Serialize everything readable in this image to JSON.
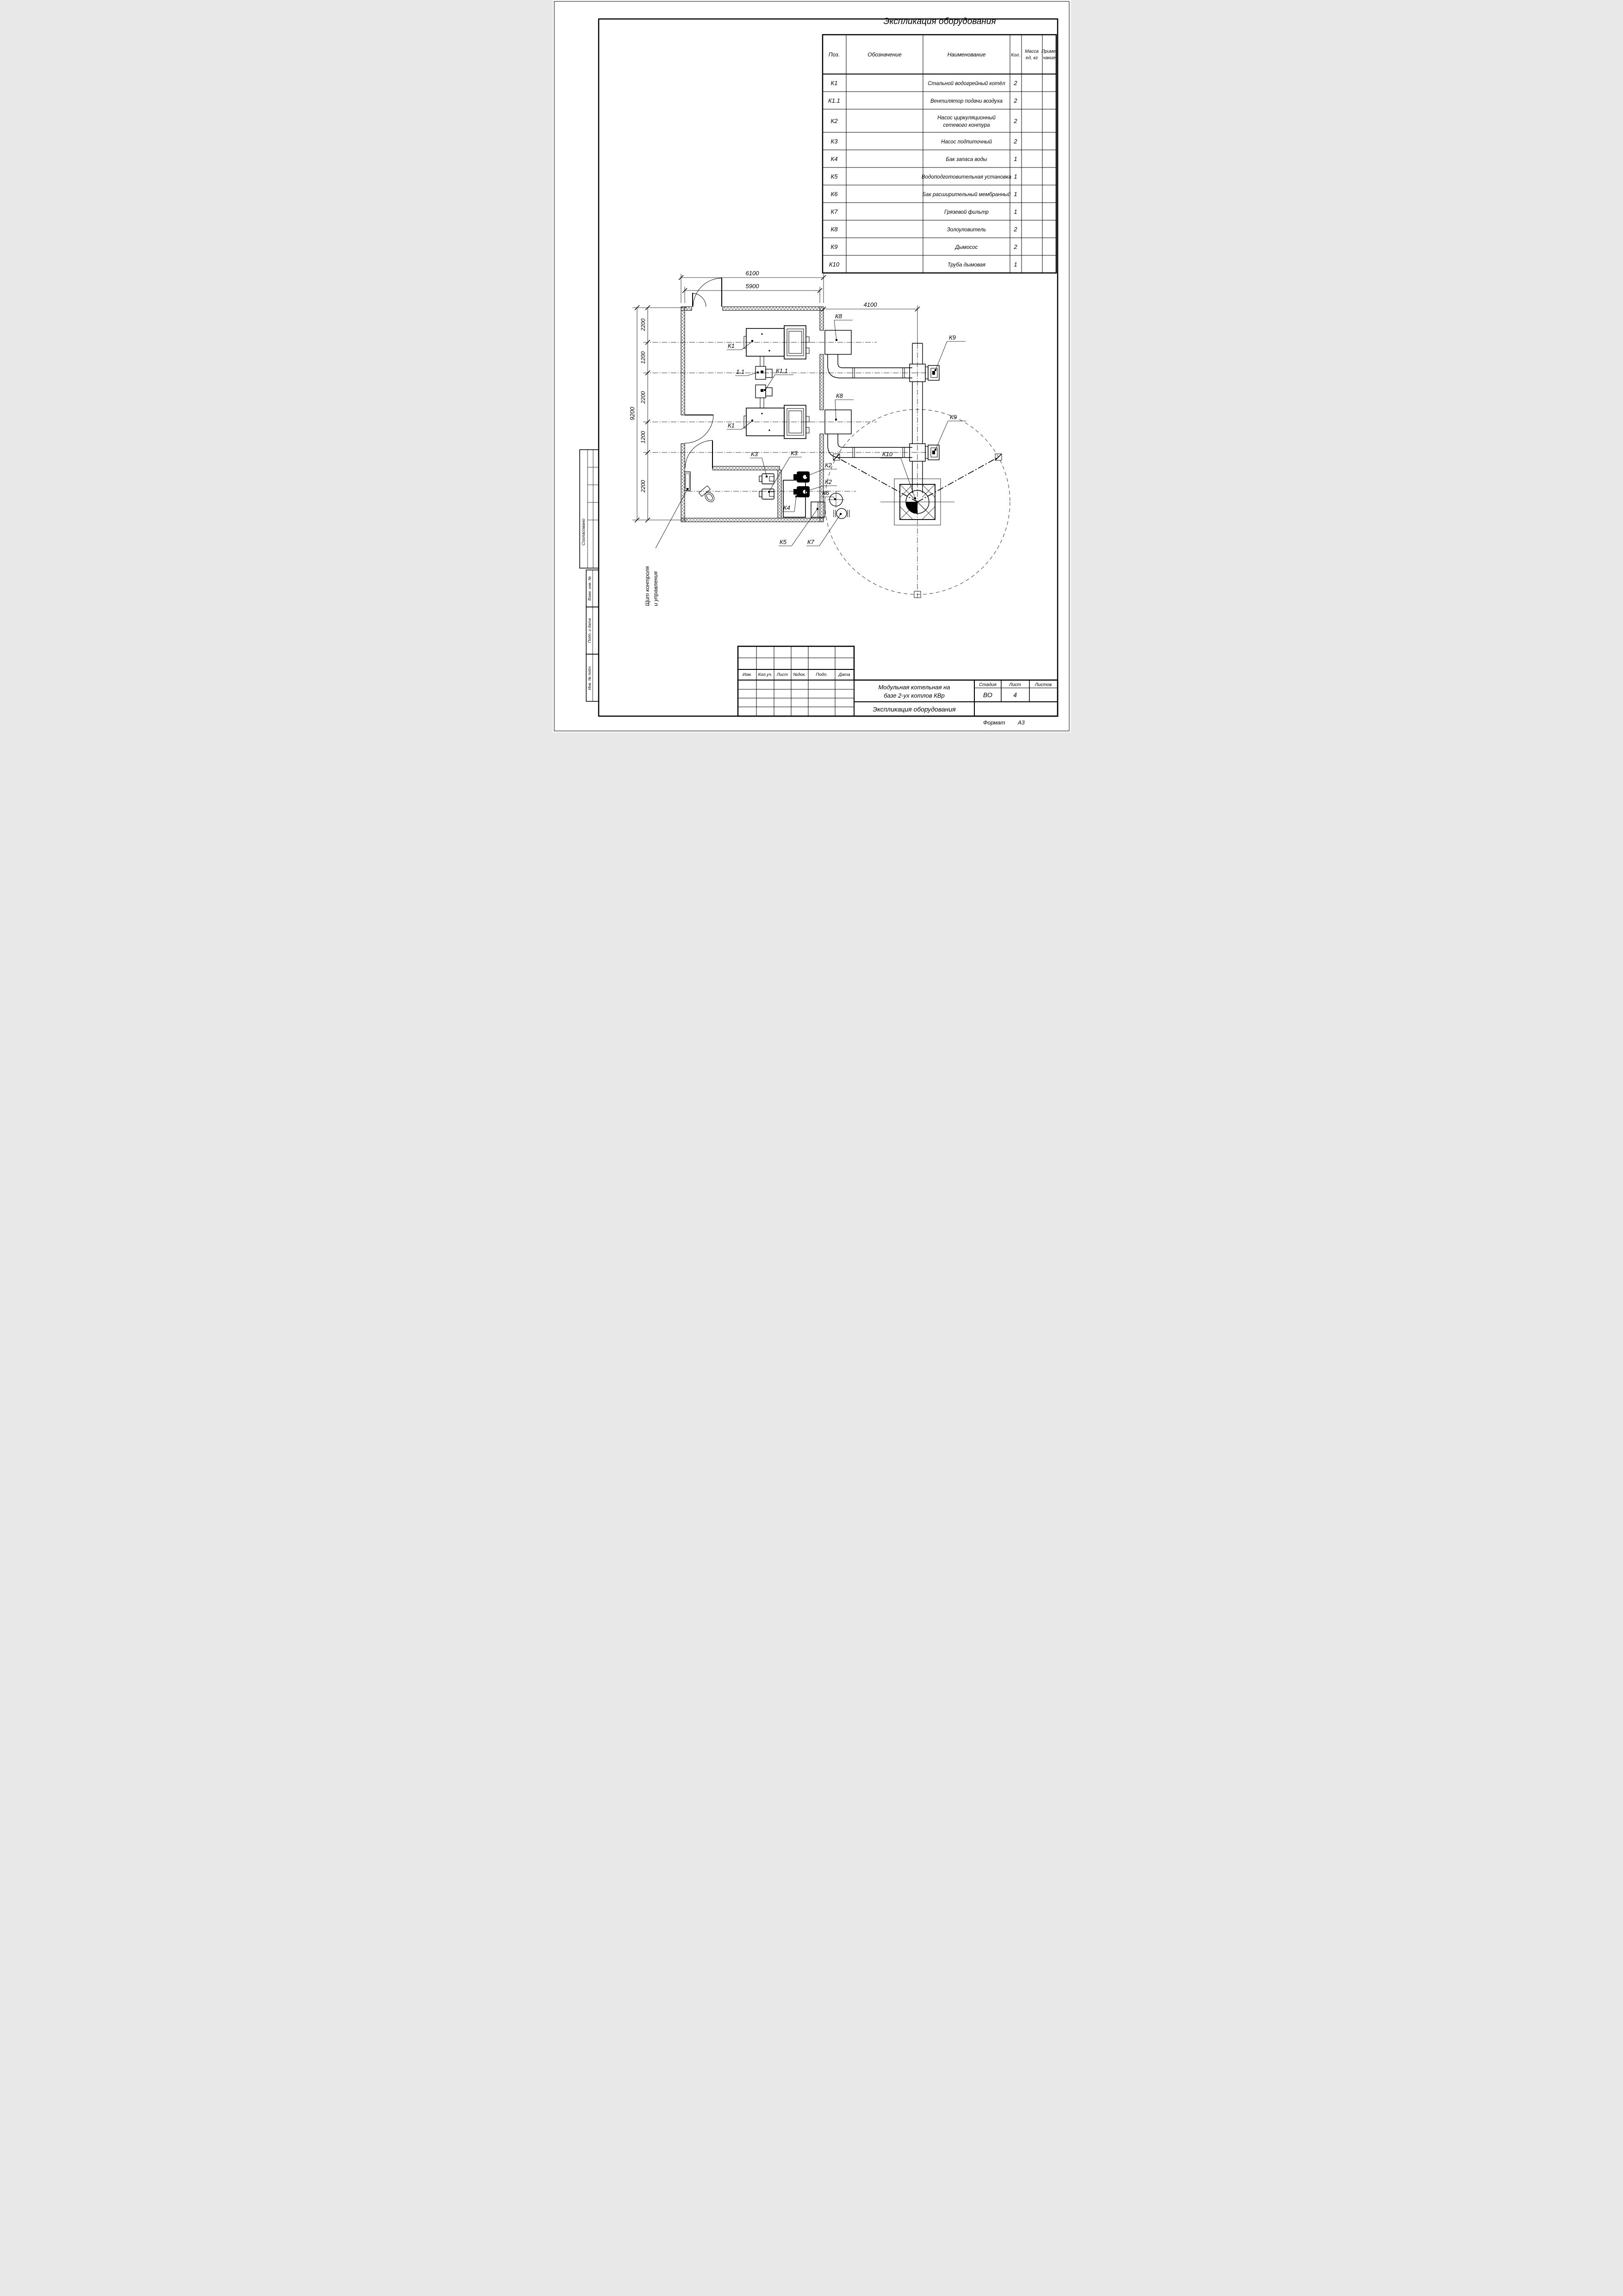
{
  "drawing_title": "Экспликация оборудования",
  "equipment_table": {
    "title": "Экспликация оборудования",
    "headers": {
      "pos": "Поз.",
      "designation": "Обозначение",
      "name": "Наименование",
      "qty": "Кол.",
      "mass_l1": "Масса",
      "mass_l2": "ед, кг",
      "note_l1": "Приме-",
      "note_l2": "чание"
    },
    "rows": [
      {
        "pos": "К1",
        "name": "Стальной водогрейный котёл",
        "qty": "2"
      },
      {
        "pos": "К1.1",
        "name": "Вентилятор подачи воздуха",
        "qty": "2"
      },
      {
        "pos": "К2",
        "name": "Насос циркуляционный",
        "name2": "сетевого контура",
        "qty": "2"
      },
      {
        "pos": "К3",
        "name": "Насос подпиточный",
        "qty": "2"
      },
      {
        "pos": "К4",
        "name": "Бак запаса воды",
        "qty": "1"
      },
      {
        "pos": "К5",
        "name": "Водоподготовительная установка",
        "qty": "1"
      },
      {
        "pos": "К6",
        "name": "Бак расширительный мембранный",
        "qty": "1"
      },
      {
        "pos": "К7",
        "name": "Грязевой фильтр",
        "qty": "1"
      },
      {
        "pos": "К8",
        "name": "Золоуловитель",
        "qty": "2"
      },
      {
        "pos": "К9",
        "name": "Дымосос",
        "qty": "2"
      },
      {
        "pos": "К10",
        "name": "Труба дымовая",
        "qty": "1"
      }
    ]
  },
  "plan": {
    "dims": {
      "d6100": "6100",
      "d5900": "5900",
      "d4100": "4100",
      "d9200": "9200",
      "chain": [
        "2200",
        "1200",
        "2200",
        "1200",
        "2200"
      ]
    },
    "labels": {
      "k1a": "К1",
      "k1b": "К1",
      "fan1": "1.1",
      "fan2": "К1.1",
      "k2a": "К2",
      "k2b": "К2",
      "k3a": "К3",
      "k3b": "К3",
      "k4": "К4",
      "k5": "К5",
      "k6": "К6",
      "k7": "К7",
      "k8a": "К8",
      "k8b": "К8",
      "k9a": "К9",
      "k9b": "К9",
      "k10": "К10",
      "panel_l1": "Щит контроля",
      "panel_l2": "и управления"
    }
  },
  "title_block": {
    "rev_headers": [
      "Изм.",
      "Кол.уч.",
      "Лист",
      "№док.",
      "Подп.",
      "Дата"
    ],
    "project_title_l1": "Модульная котельная на",
    "project_title_l2": "базе 2-ух котлов КВр",
    "sheet_title": "Экспликация оборудования",
    "stage_label": "Стадия",
    "sheet_label": "Лист",
    "sheets_label": "Листов",
    "stage_value": "ВО",
    "sheet_value": "4",
    "sheets_value": ""
  },
  "sidebar": {
    "agreed": "Согласовано",
    "cells": [
      "Взам. инв. №",
      "Подп. и дата",
      "Инв. № подл."
    ]
  },
  "footer": {
    "format_label": "Формат",
    "format_value": "А3"
  }
}
